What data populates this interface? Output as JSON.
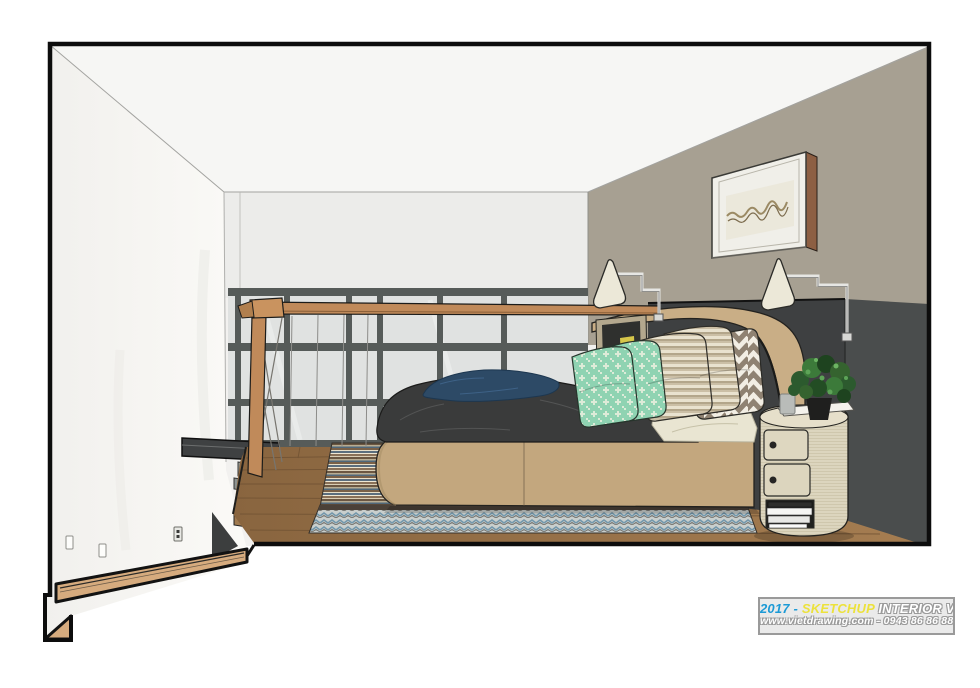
{
  "scene": {
    "title": "SketchUp loft bedroom - section perspective render",
    "style": "sketchup-shaded-section-cut",
    "objects": [
      "ceiling",
      "left-cut-wall",
      "back-wall-bulkhead",
      "taupe-accent-wall",
      "glazed-stair-partition",
      "steel-beam",
      "stair-flight",
      "loft-railing",
      "wood-platform-floor",
      "area-rug",
      "platform-bed",
      "duvet",
      "navy-throw",
      "mint-pillows",
      "striped-pillows",
      "chevron-pillow",
      "headboard",
      "headboard-panel",
      "wall-lamps",
      "framed-artwork",
      "small-leaning-frame",
      "nightstand",
      "books",
      "potted-plant",
      "wall-outlets",
      "section-cut-wood"
    ]
  },
  "palette": {
    "page_bg": "#ffffff",
    "section_outline": "#0d0d0d",
    "interior_base": "#f2f1ef",
    "ceiling": "#f6f6f4",
    "back_wall": "#ececea",
    "accent_wall_taupe": "#a7a092",
    "headboard_panel": "#3e4041",
    "right_wall_dark": "#4a4d4d",
    "glass": "#e0e2e1",
    "mullion": "#565b59",
    "rail_wood": "#c08a5a",
    "cut_wood": "#d6ab7e",
    "steel_beam": "#3f4142",
    "bed_base": "#c3a77e",
    "headboard": "#c9ae86",
    "duvet": "#3a3b3b",
    "navy_throw": "#2d4a66",
    "cream_sheet": "#e9e5d2",
    "mint_pillow": "#8fd3b2",
    "stripe_pillow": "#b0a48a",
    "chevron_pillow": "#8f8272",
    "nightstand": "#dcd5be",
    "plant_green": "#35632f",
    "lamp_shade": "#ece8d8",
    "frame_wood": "#8d5f43",
    "art_mat": "#f0efe9"
  },
  "watermark": {
    "year_prefix": "2017 -",
    "brand": "SKETCHUP",
    "series": "INTERIOR VOL.6",
    "website_line": "www.vietdrawing.com - 0943 86 86 88",
    "year_color": "#1c9ad6",
    "brand_color": "#ece23c"
  }
}
